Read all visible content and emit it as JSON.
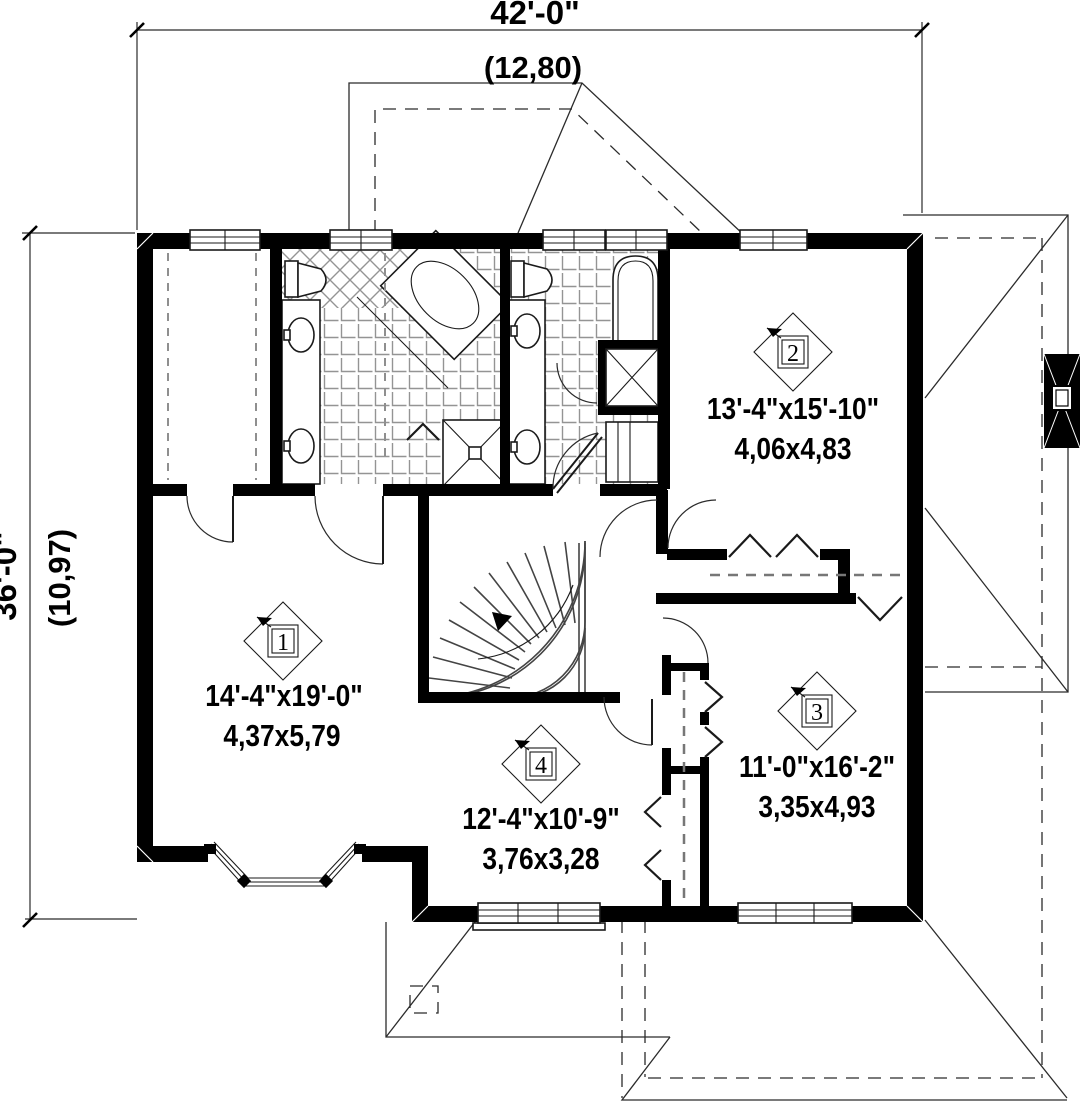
{
  "dimensions": {
    "top": {
      "imperial": "42'-0\"",
      "metric": "(12,80)"
    },
    "left": {
      "imperial": "36'-0\"",
      "metric": "(10,97)"
    }
  },
  "rooms": [
    {
      "number": "1",
      "imperial": "14'-4\"x19'-0\"",
      "metric": "4,37x5,79"
    },
    {
      "number": "2",
      "imperial": "13'-4\"x15'-10\"",
      "metric": "4,06x4,83"
    },
    {
      "number": "3",
      "imperial": "11'-0\"x16'-2\"",
      "metric": "3,35x4,93"
    },
    {
      "number": "4",
      "imperial": "12'-4\"x10'-9\"",
      "metric": "3,76x3,28"
    }
  ],
  "colors": {
    "wall": "#000000",
    "tile_grout": "#949494",
    "line": "#2b2b2b"
  }
}
